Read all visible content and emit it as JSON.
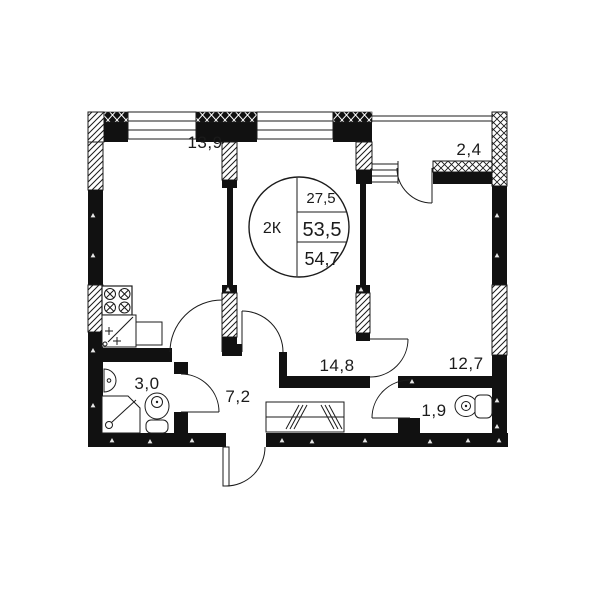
{
  "floorplan": {
    "legend": {
      "type_label": "2К",
      "area_living": "27,5",
      "area_main": "53,5",
      "area_total": "54,7"
    },
    "rooms": {
      "kitchen_living": "13,9",
      "balcony": "2,4",
      "living": "14,8",
      "bedroom": "12,7",
      "bathroom": "3,0",
      "hallway": "7,2",
      "wc": "1,9"
    },
    "colors": {
      "line": "#1b1b1b",
      "background": "#ffffff"
    }
  }
}
